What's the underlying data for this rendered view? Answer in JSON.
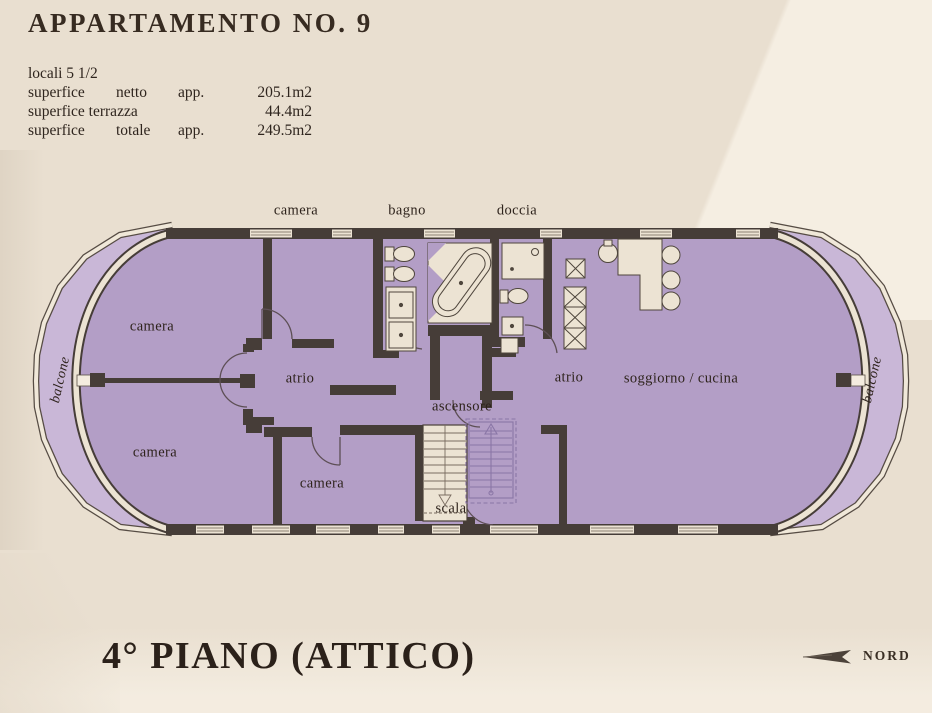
{
  "header": {
    "title": "APPARTAMENTO NO. 9"
  },
  "info": {
    "rows": [
      {
        "c1": "locali 5 1/2",
        "c2": "",
        "c3": "",
        "value": ""
      },
      {
        "c1": "superfice",
        "c2": "netto",
        "c3": "app.",
        "value": "205.1m2"
      },
      {
        "c1": "superfice terrazza",
        "c2": "",
        "c3": "",
        "value": "44.4m2"
      },
      {
        "c1": "superfice",
        "c2": "totale",
        "c3": "app.",
        "value": "249.5m2"
      }
    ]
  },
  "plan": {
    "labels": {
      "camera_top": "camera",
      "bagno": "bagno",
      "doccia": "doccia",
      "camera_upper_left": "camera",
      "camera_lower_left": "camera",
      "camera_bottom": "camera",
      "atrio_left": "atrio",
      "atrio_right": "atrio",
      "ascensore": "ascensore",
      "scala": "scala",
      "soggiorno": "soggiorno / cucina",
      "balcone_left": "balcone",
      "balcone_right": "balcone"
    }
  },
  "footer": {
    "floor_label": "4° PIANO (ATTICO)",
    "compass_label": "NORD"
  },
  "colors": {
    "background": "#e9dfd0",
    "interior": "#b39ec6",
    "balcony": "#c9b7d7",
    "wall": "#463d38",
    "fixture": "#ece3d3",
    "text": "#2e241d",
    "stair_outline": "#8a76a6"
  }
}
